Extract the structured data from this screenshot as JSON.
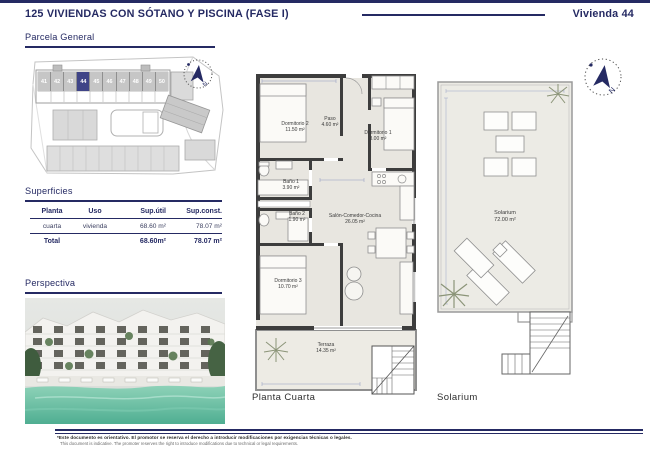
{
  "header": {
    "title": "125 VIVIENDAS CON SÓTANO Y PISCINA (FASE I)",
    "unit": "Vivienda 44"
  },
  "sections": {
    "parcela": "Parcela General",
    "superficies": "Superficies",
    "perspectiva": "Perspectiva"
  },
  "parcela": {
    "units": [
      "41",
      "42",
      "43",
      "44",
      "45",
      "46",
      "47",
      "48",
      "49",
      "50"
    ],
    "highlighted_unit": "44",
    "compass_label": "N"
  },
  "superficies_table": {
    "columns": [
      "Planta",
      "Uso",
      "Sup.útil",
      "Sup.const."
    ],
    "row": {
      "planta": "cuarta",
      "uso": "vivienda",
      "util": "68.60 m²",
      "const": "78.07 m²"
    },
    "total": {
      "label": "Total",
      "util": "68.60m²",
      "const": "78.07 m²"
    }
  },
  "planta": {
    "caption": "Planta Cuarta",
    "rooms": {
      "dormitorio2": {
        "name": "Dormitorio 2",
        "area": "11.50 m²"
      },
      "paso": {
        "name": "Paso",
        "area": "4.60 m²"
      },
      "dormitorio1": {
        "name": "Dormitorio 1",
        "area": "8.00 m²"
      },
      "bano1": {
        "name": "Baño 1",
        "area": "3.90 m²"
      },
      "bano2": {
        "name": "Baño 2",
        "area": "1.90 m²"
      },
      "salon": {
        "name": "Salón-Comedor-Cocina",
        "area": "26.05 m²"
      },
      "dormitorio3": {
        "name": "Dormitorio 3",
        "area": "10.70 m²"
      },
      "terraza": {
        "name": "Terraza",
        "area": "14.35 m²"
      }
    }
  },
  "solarium": {
    "caption": "Solarium",
    "room": {
      "name": "Solarium",
      "area": "72.00 m²"
    },
    "compass_label": "N"
  },
  "footer": {
    "line_es": "*Este documento es orientativo. El promotor se reserva el derecho a introducir modificaciones por exigencias técnicas o legales.",
    "line_en": "This document is indicative. The promoter reserves the right to introduce modifications due to technical or legal requirements."
  },
  "colors": {
    "navy": "#252a63",
    "wall": "#3d3d3d",
    "floor": "#e8e6e0",
    "highlight": "#3f4487"
  }
}
